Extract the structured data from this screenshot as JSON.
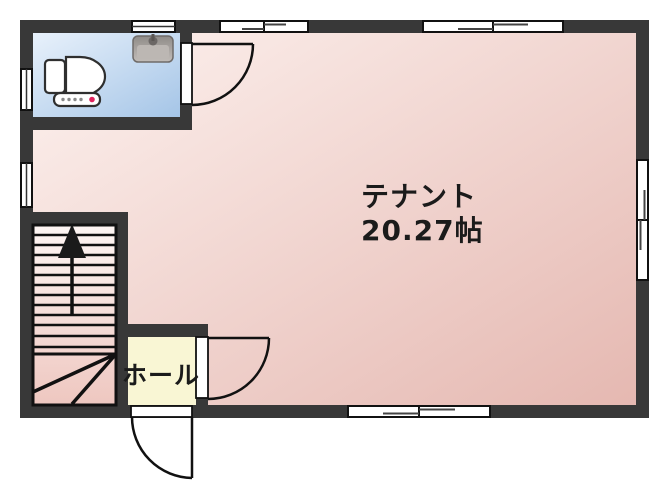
{
  "plan": {
    "type": "floor-plan",
    "rooms": {
      "tenant": {
        "name": "テナント",
        "area": "20.27帖"
      },
      "hall": {
        "name": "ホール"
      },
      "toilet": {
        "name": "",
        "fixtures": [
          "toilet",
          "hand-wash-sink"
        ]
      },
      "staircase": {
        "direction": "up"
      }
    },
    "colors": {
      "wall": "#383838",
      "outline": "#111111",
      "tenant_gradient": [
        "#fdf2ef",
        "#e5b8b1"
      ],
      "toilet_gradient": [
        "#e8f1fb",
        "#a5c5e7"
      ],
      "stairs_gradient": [
        "#fdf5f3",
        "#eec7c0"
      ],
      "hall_fill": "#f9f6d4",
      "window_fill": "#ffffff",
      "toilet_button_red": "#e0245e",
      "sink_gray": "#a09b97"
    },
    "icons": {
      "toilet": "toilet-icon",
      "sink": "hand-wash-sink-icon",
      "stairs_arrow": "up-arrow-icon"
    },
    "counts": {
      "windows": 7,
      "doors": 3
    }
  }
}
